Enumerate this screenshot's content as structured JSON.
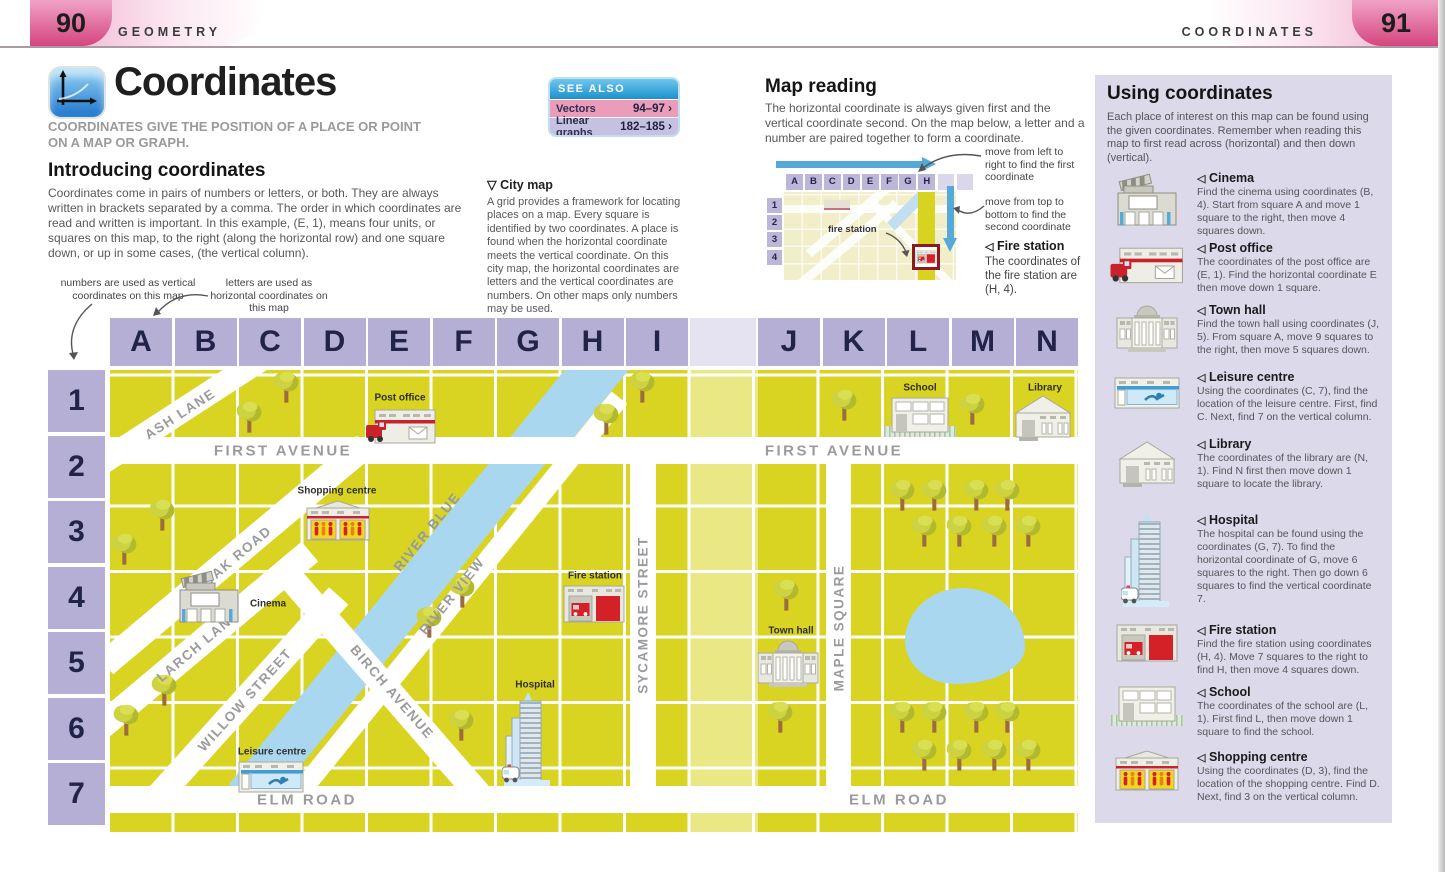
{
  "header": {
    "left_num": "90",
    "left_label": "GEOMETRY",
    "right_label": "COORDINATES",
    "right_num": "91"
  },
  "title_block": {
    "title": "Coordinates",
    "subtitle": "COORDINATES GIVE THE POSITION OF A PLACE OR POINT ON A MAP OR GRAPH."
  },
  "see_also": {
    "header": "SEE ALSO",
    "chevron": "›",
    "items": [
      {
        "label": "Vectors",
        "pages": "94–97"
      },
      {
        "label": "Linear graphs",
        "pages": "182–185"
      }
    ]
  },
  "intro": {
    "heading": "Introducing coordinates",
    "body": "Coordinates come in pairs of numbers or letters, or both. They are always written in brackets separated by a comma. The order in which coordinates are read and written is important. In this example, (E, 1), means four units, or squares on this map, to the right (along the horizontal row) and one square down, or up in some cases, (the vertical column)."
  },
  "city_note": {
    "marker": "▽",
    "heading": "City map",
    "body": "A grid provides a framework for locating places on a map. Every square is identified by two coordinates. A place is found when the horizontal coordinate meets the vertical coordinate. On this city map, the horizontal coordinates are letters and the vertical coordinates are numbers. On other maps only numbers may be used."
  },
  "map_reading": {
    "heading": "Map reading",
    "body": "The horizontal coordinate is always given first and the vertical coordinate second. On the map below, a letter and a number are paired together to form a coordinate.",
    "note1": "move from left to right to find the first coordinate",
    "note2": "move from top to bottom to find the second coordinate",
    "mini": {
      "columns": [
        "A",
        "B",
        "C",
        "D",
        "E",
        "F",
        "G",
        "H"
      ],
      "rows": [
        "1",
        "2",
        "3",
        "4"
      ],
      "station_label": "fire station"
    },
    "callout": {
      "marker": "◁",
      "heading": "Fire station",
      "body": "The coordinates of the fire station are (H, 4)."
    }
  },
  "grid_notes": {
    "numbers": "numbers are used as vertical coordinates on this map",
    "letters": "letters are used as horizontal coordinates on this map"
  },
  "map": {
    "columns": [
      "A",
      "B",
      "C",
      "D",
      "E",
      "F",
      "G",
      "H",
      "I",
      "J",
      "K",
      "L",
      "M",
      "N"
    ],
    "rows": [
      "1",
      "2",
      "3",
      "4",
      "5",
      "6",
      "7"
    ],
    "streets": {
      "ash": "ASH LANE",
      "first_avenue": "FIRST AVENUE",
      "oak": "OAK ROAD",
      "larch": "LARCH LANE",
      "willow": "WILLOW STREET",
      "birch": "BIRCH AVENUE",
      "river_blue": "RIVER BLUE",
      "river_view": "RIVER VIEW",
      "sycamore": "SYCAMORE STREET",
      "maple": "MAPLE SQUARE",
      "elm_road": "ELM ROAD"
    },
    "places": {
      "post_office": "Post office",
      "shopping_centre": "Shopping centre",
      "cinema": "Cinema",
      "fire_station": "Fire station",
      "town_hall": "Town hall",
      "hospital": "Hospital",
      "leisure_centre": "Leisure centre",
      "school": "School",
      "library": "Library"
    }
  },
  "sidebar": {
    "heading": "Using coordinates",
    "marker": "◁",
    "intro": "Each place of interest on this map can be found using the given coordinates. Remember when reading this map to first read across (horizontal) and then down (vertical).",
    "entries": [
      {
        "icon": "cinema-icon",
        "name": "Cinema",
        "body": "Find the cinema using coordinates (B, 4). Start from square A and move 1 square to the right, then move 4 squares down."
      },
      {
        "icon": "post-office-icon",
        "name": "Post office",
        "body": "The coordinates of the post office are (E, 1). Find the horizontal coordinate E then move down 1 square."
      },
      {
        "icon": "town-hall-icon",
        "name": "Town hall",
        "body": "Find the town hall using coordinates (J, 5). From square A, move 9 squares to the right, then move 5 squares down."
      },
      {
        "icon": "leisure-centre-icon",
        "name": "Leisure centre",
        "body": "Using the coordinates (C, 7), find the location of the leisure centre. First, find C. Next, find 7 on the vertical column."
      },
      {
        "icon": "library-icon",
        "name": "Library",
        "body": "The coordinates of the library are (N, 1). Find N first then move down 1 square to locate the library."
      },
      {
        "icon": "hospital-icon",
        "name": "Hospital",
        "body": "The hospital can be found using the coordinates (G, 7). To find the horizontal coordinate of G, move 6 squares to the right. Then go down 6 squares to find the vertical coordinate 7."
      },
      {
        "icon": "fire-station-icon",
        "name": "Fire station",
        "body": "Find the fire station using coordinates (H, 4). Move 7 squares to the right to find H, then move 4 squares down."
      },
      {
        "icon": "school-icon",
        "name": "School",
        "body": "The coordinates of the school are (L, 1). First find L, then move down 1 square to find the school."
      },
      {
        "icon": "shopping-centre-icon",
        "name": "Shopping centre",
        "body": "Using the coordinates (D, 3), find the location of the shopping centre. Find D. Next, find 3 on the vertical column."
      }
    ]
  },
  "colors": {
    "map_yellow": "#d9d321",
    "grid_lavender": "#b5afd6",
    "river_blue": "#a9d7f0",
    "sidebar_bg": "#dcd9ea",
    "page_pink": "#d5457f",
    "arrow_blue": "#54a9d8",
    "fire_red": "#d42027"
  }
}
